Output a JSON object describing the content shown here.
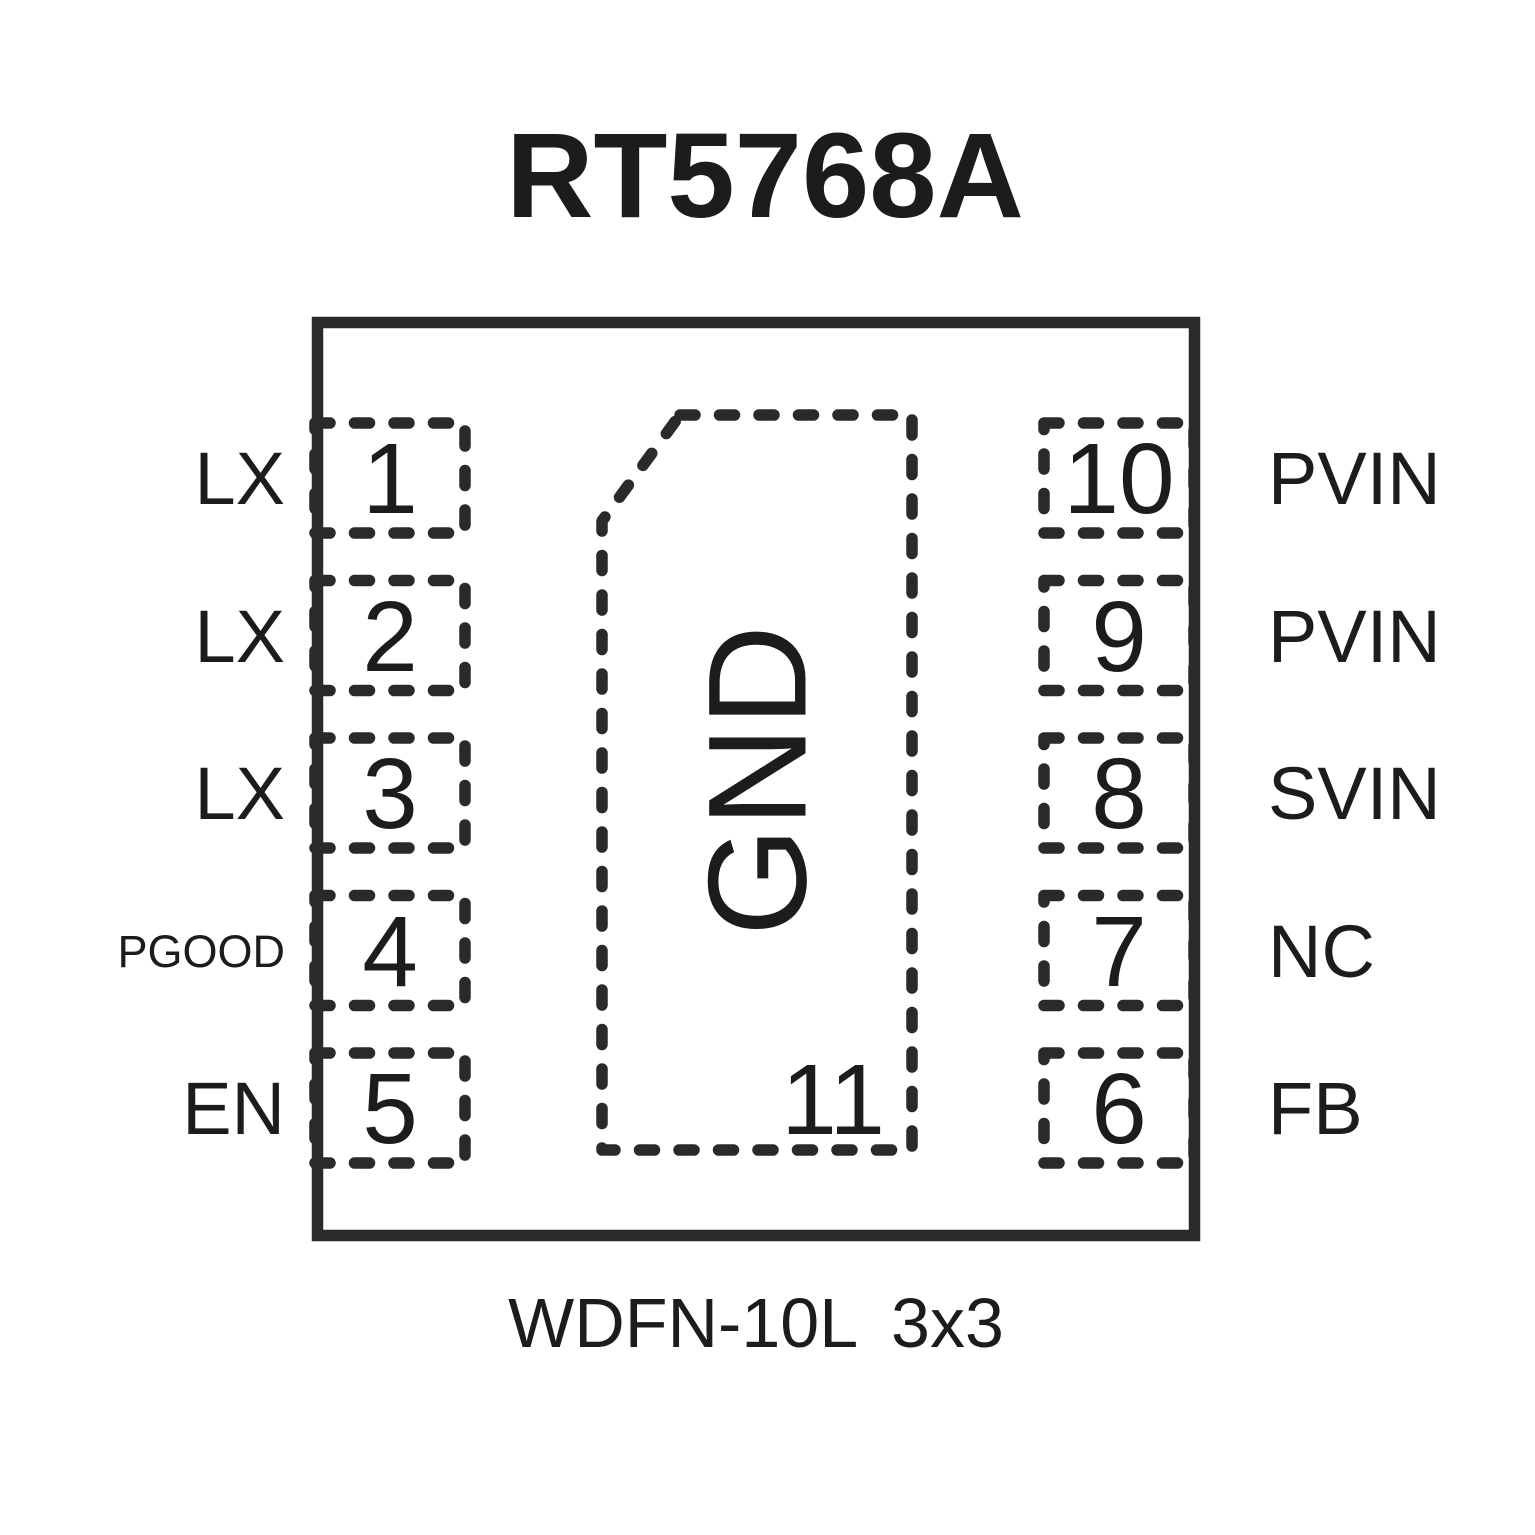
{
  "title": "RT5768A",
  "caption": "WDFN-10L 3x3",
  "colors": {
    "line": "#2a2a2a",
    "ink": "#1c1c1c",
    "bg": "#ffffff"
  },
  "chip": {
    "pins_left": [
      {
        "number": "1",
        "label": "LX"
      },
      {
        "number": "2",
        "label": "LX"
      },
      {
        "number": "3",
        "label": "LX"
      },
      {
        "number": "4",
        "label": "PGOOD"
      },
      {
        "number": "5",
        "label": "EN"
      }
    ],
    "pins_right": [
      {
        "number": "10",
        "label": "PVIN"
      },
      {
        "number": "9",
        "label": "PVIN"
      },
      {
        "number": "8",
        "label": "SVIN"
      },
      {
        "number": "7",
        "label": "NC"
      },
      {
        "number": "6",
        "label": "FB"
      }
    ],
    "thermal_pad": {
      "number": "11",
      "label": "GND"
    }
  }
}
